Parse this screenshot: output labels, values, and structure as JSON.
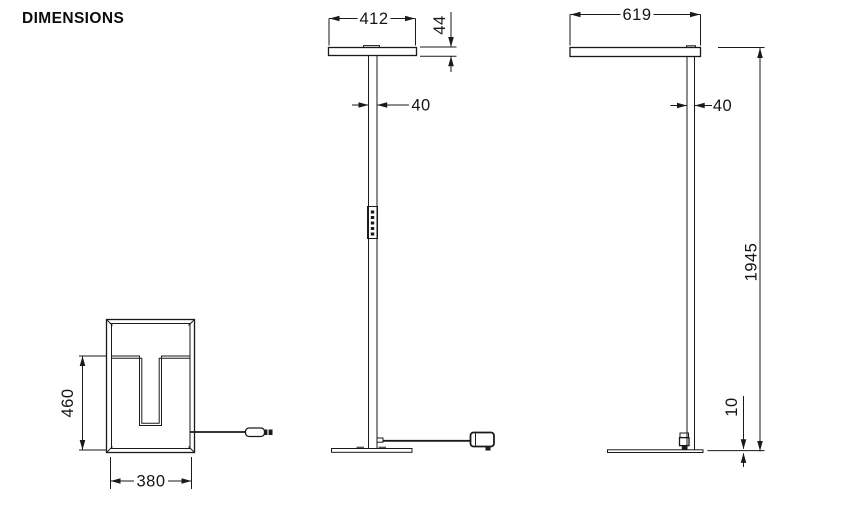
{
  "title": "DIMENSIONS",
  "views": {
    "top_view": {
      "label": "base top view",
      "depth": "460",
      "width": "380"
    },
    "front_view": {
      "label": "front view",
      "head_width": "412",
      "head_height": "44",
      "pole_width": "40"
    },
    "side_view": {
      "label": "side view",
      "head_depth": "619",
      "pole_depth": "40",
      "total_height": "1945",
      "base_height": "10"
    }
  }
}
